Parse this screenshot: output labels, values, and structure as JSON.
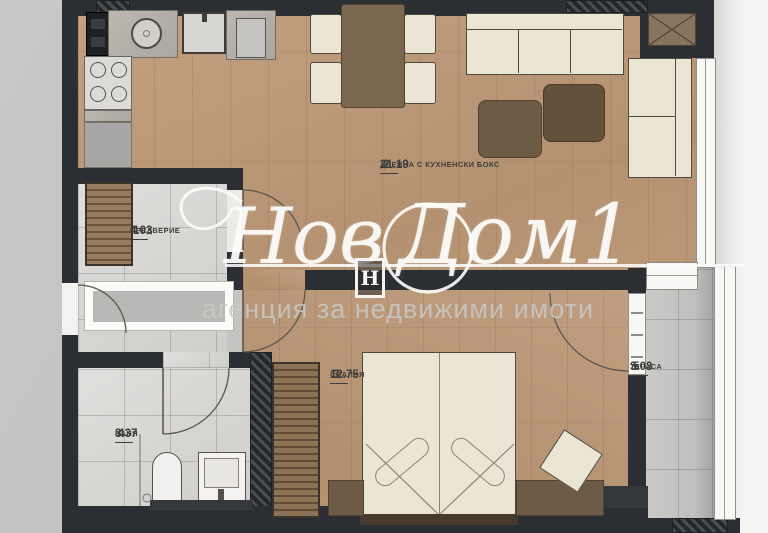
{
  "plan": {
    "rooms": [
      {
        "number": "2",
        "area": "21.19",
        "name": "ДНЕВНА С КУХНЕНСКИ БОКС"
      },
      {
        "number": "1",
        "area": "4.03",
        "name": "ПРЕДВЕРИЕ"
      },
      {
        "number": "3",
        "area": "12.75",
        "name": "СПАЛНЯ"
      },
      {
        "number": "4",
        "area": "3.37",
        "name": "БАНЯ"
      },
      {
        "number": "5",
        "area": "3.03",
        "name": "ТЕРАСА"
      }
    ]
  },
  "watermark": {
    "brand_first": "Нов",
    "brand_second": "Дом1",
    "logo_letter": "Н",
    "tagline": "агенция за недвижими имоти"
  },
  "colors": {
    "wall": "#2b2e32",
    "wood_floor": "#bb9876",
    "tile_floor": "#d9d8d6",
    "terrace_floor": "#c5c4c2",
    "furniture_cream": "#ebe5d3",
    "furniture_brown": "#74624b",
    "watermark_white": "#fcfcfa",
    "tagline_gray": "#c7c7c4"
  }
}
